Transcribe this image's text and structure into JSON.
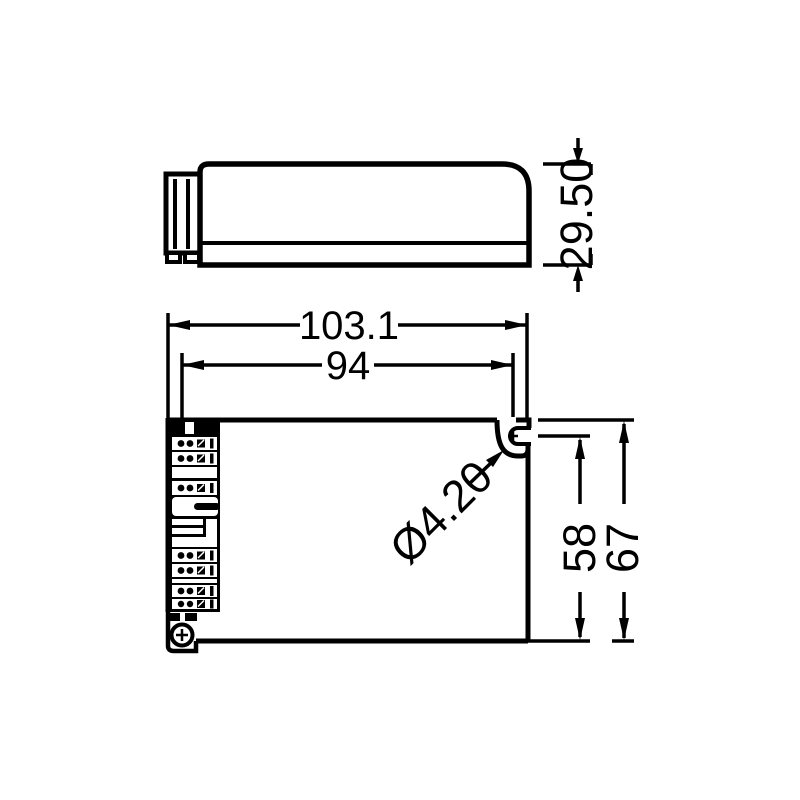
{
  "drawing": {
    "background_color": "#ffffff",
    "ink_color": "#000000",
    "views": {
      "side_view_name": "side-elevation",
      "plan_view_name": "plan-view"
    },
    "dimensions": {
      "overall_width": "103.1",
      "mounting_pitch": "94",
      "height": "29.50",
      "hole_center_to_bottom": "58",
      "overall_depth": "67",
      "mounting_hole_diameter": "Ø4.20"
    }
  }
}
